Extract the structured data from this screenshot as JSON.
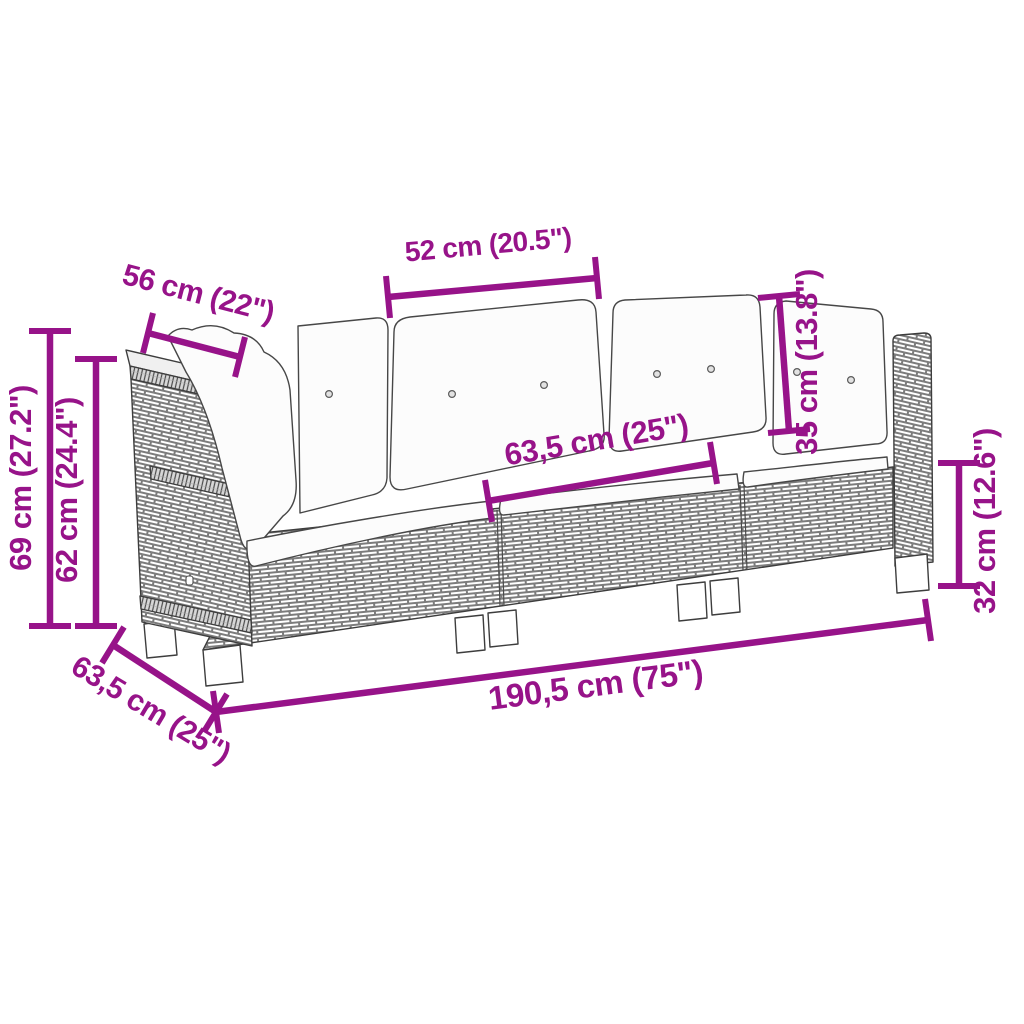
{
  "diagram": {
    "kind": "furniture-dimension-diagram",
    "accent_color": "#971389",
    "line_art_color": "#3d3d3d",
    "background_color": "#ffffff",
    "dimensions": {
      "cushion_width": "52 cm (20.5\")",
      "armrest_top_length": "56 cm (22\")",
      "back_cushion_height": "35 cm (13.8\")",
      "overall_height": "69 cm (27.2\")",
      "armrest_height": "62 cm (24.4\")",
      "seat_depth": "63,5 cm (25\")",
      "seat_height": "32 cm (12.6\")",
      "module_depth": "63,5 cm (25\")",
      "overall_width": "190,5 cm (75\")"
    }
  }
}
